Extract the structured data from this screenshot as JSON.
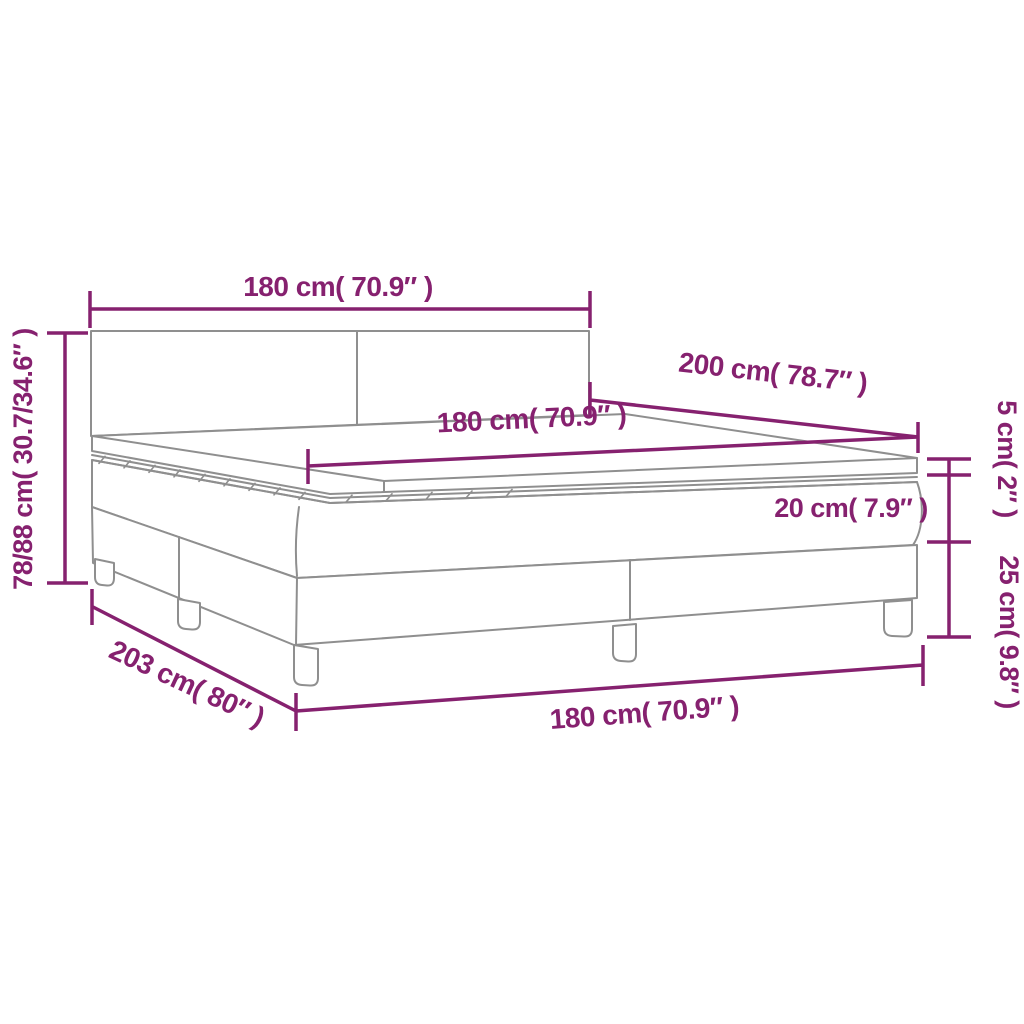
{
  "diagram": {
    "type": "product-dimension-diagram",
    "product": "box spring bed with headboard, mattress and topper",
    "colors": {
      "dimension_accent": "#86216F",
      "drawing_outline": "#8F8F8F",
      "background": "#FFFFFF"
    },
    "labels": {
      "headboard_width": "180 cm( 70.9″ )",
      "total_height": "78/88 cm( 30.7/34.6″ )",
      "bed_length": "200 cm( 78.7″ )",
      "mattress_width": "180 cm( 70.9″ )",
      "topper_height": "5 cm( 2″ )",
      "mattress_height": "20 cm( 7.9″ )",
      "base_height": "25 cm( 9.8″ )",
      "total_length": "203 cm( 80″ )",
      "base_width": "180 cm( 70.9″ )"
    }
  }
}
